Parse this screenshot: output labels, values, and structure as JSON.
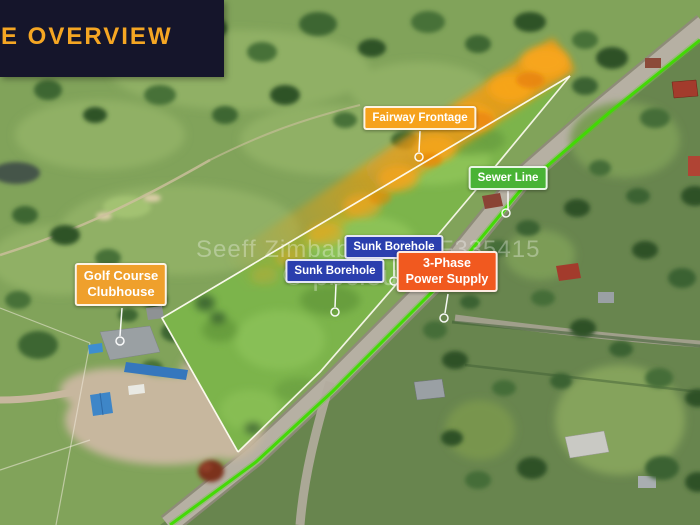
{
  "banner": {
    "title": "E OVERVIEW"
  },
  "annotations": {
    "fairway_frontage": "Fairway Frontage",
    "sewer_line": "Sewer Line",
    "sunk_borehole_upper": "Sunk Borehole",
    "sunk_borehole_lower": "Sunk Borehole",
    "power_line1": "3-Phase",
    "power_line2": "Power Supply",
    "clubhouse_line1": "Golf Course",
    "clubhouse_line2": "Clubhouse"
  },
  "watermark": {
    "line1": "Seeff Zimbabwe - SLF335415",
    "line2": "© pbcloud"
  },
  "colors": {
    "banner_bg": "#15152B",
    "banner_text": "#F5A623",
    "fairway_frontage": "#F6A21C",
    "sewer_line": "#49B335",
    "borehole": "#2B3FAE",
    "power": "#F1591F",
    "clubhouse": "#EFA02C",
    "boundary": "#FFFDF2",
    "sewer_path": "#3FDB00",
    "fairway_highlight": "#F59B0B"
  }
}
